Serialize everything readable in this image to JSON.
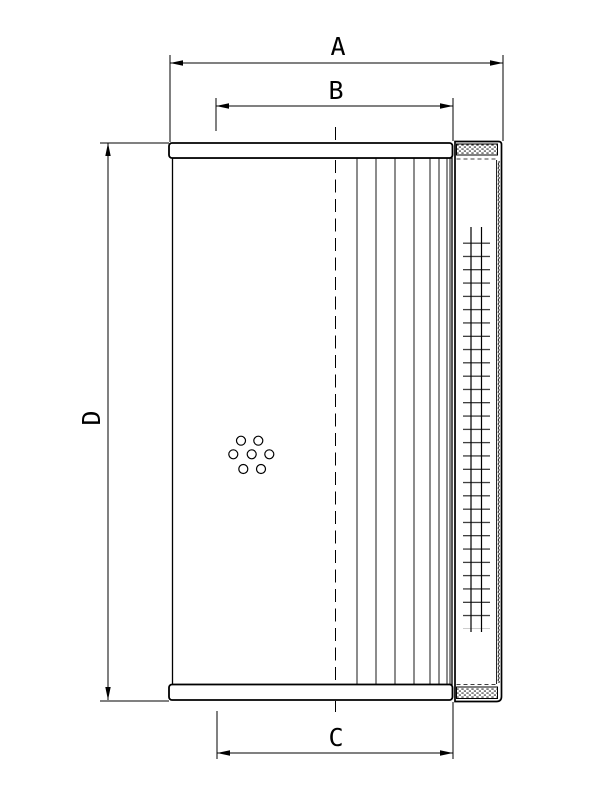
{
  "drawing": {
    "background_color": "#ffffff",
    "line_color": "#000000",
    "dimensions": {
      "a": {
        "label": "A"
      },
      "b": {
        "label": "B"
      },
      "c": {
        "label": "C"
      },
      "d": {
        "label": "D"
      }
    },
    "features": {
      "bypass_hole_count": 7,
      "pleat_line_count": 8
    }
  }
}
